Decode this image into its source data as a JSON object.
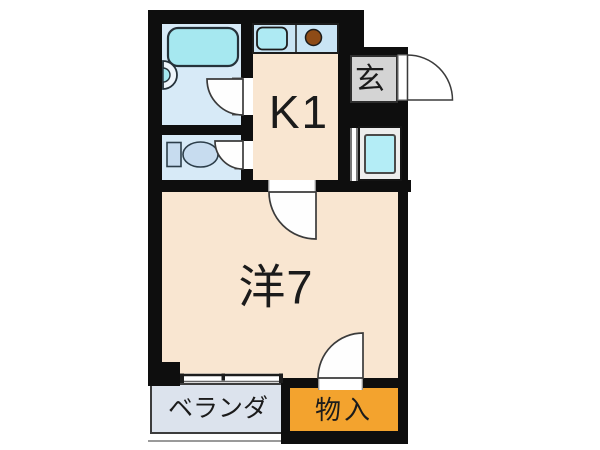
{
  "floor_plan": {
    "type": "japanese-apartment-floor-plan",
    "rooms": {
      "kitchen": {
        "label": "K1"
      },
      "entrance": {
        "label": "玄"
      },
      "western_room": {
        "label": "洋7"
      },
      "veranda": {
        "label": "ベランダ"
      },
      "storage": {
        "label": "物入"
      }
    },
    "fixtures": [
      "bathtub-icon",
      "shower-faucet-icon",
      "toilet-icon",
      "kitchen-sink-icon",
      "burner-icon",
      "washer-pan-icon",
      "sliding-window-icon",
      "door-swing-icon"
    ],
    "colors": {
      "wall": "#0E0E0E",
      "room_fill": "#F9E6D1",
      "wet_area_fill": "#D7EAF7",
      "bathtub": "#A6E8F0",
      "kitchen_counter": "#C9E4F4",
      "sink": "#AEEAF3",
      "burner": "#8E4B16",
      "entrance_fill": "#D4D4D4",
      "washer_pan": "#B4EDF6",
      "veranda_fill": "#DCE3ED",
      "storage_fill": "#F3A32E"
    }
  }
}
